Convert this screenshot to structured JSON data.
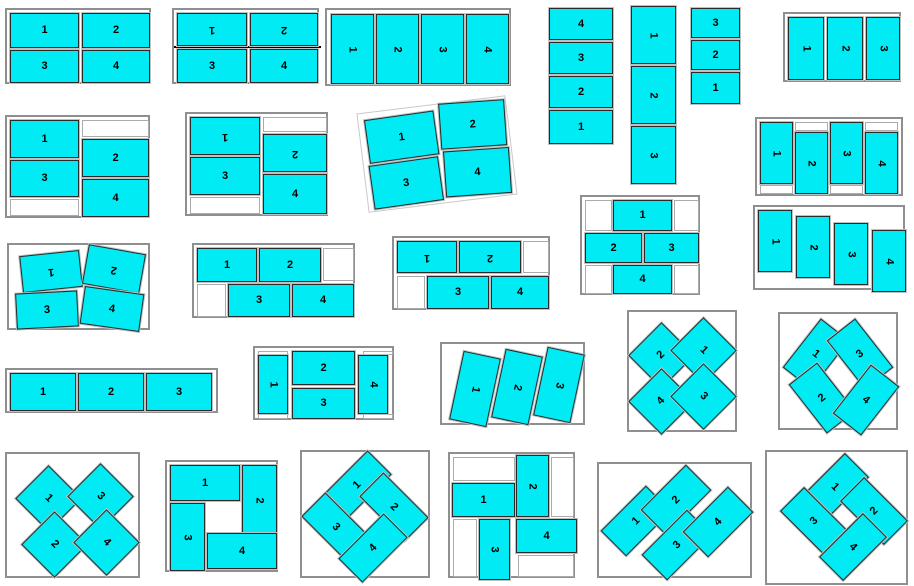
{
  "canvas": {
    "width": 914,
    "height": 586,
    "background": "#ffffff"
  },
  "palette": {
    "cell_fill": "#00ebf3",
    "cell_border": "#2a2a2a",
    "group_border": "#8f8f8f",
    "empty_cell_fill": "#ffffff",
    "separator_color": "#000000",
    "label_color": "#000000"
  },
  "groups": [
    {
      "name": "layout-2x2-grid",
      "cells": [
        "1",
        "2",
        "3",
        "4"
      ]
    },
    {
      "name": "layout-2x2-head-to-head",
      "cells": [
        "1",
        "2",
        "3",
        "4"
      ]
    },
    {
      "name": "layout-4-across-rotated",
      "cells": [
        "1",
        "2",
        "3",
        "4"
      ]
    },
    {
      "name": "layout-stack-4-reversed",
      "cells": [
        "4",
        "3",
        "2",
        "1"
      ]
    },
    {
      "name": "layout-stack-3-rotated",
      "cells": [
        "1",
        "2",
        "3"
      ]
    },
    {
      "name": "layout-stack-3-reversed",
      "cells": [
        "3",
        "2",
        "1"
      ]
    },
    {
      "name": "layout-3-across-rotated",
      "cells": [
        "1",
        "2",
        "3"
      ]
    },
    {
      "name": "layout-2col-staggered",
      "cells": [
        "1",
        "3",
        "2",
        "4"
      ]
    },
    {
      "name": "layout-2col-staggered-head-to-head",
      "cells": [
        "1",
        "3",
        "2",
        "4"
      ]
    },
    {
      "name": "layout-2x2-tilted",
      "cells": [
        "1",
        "2",
        "3",
        "4"
      ]
    },
    {
      "name": "layout-4col-alternating",
      "cells": [
        "1",
        "2",
        "3",
        "4"
      ]
    },
    {
      "name": "layout-brick-pyramid",
      "cells": [
        "1",
        "2",
        "3",
        "4"
      ]
    },
    {
      "name": "layout-2x2-jostled-head-to-head",
      "cells": [
        "1",
        "2",
        "3",
        "4"
      ]
    },
    {
      "name": "layout-brick-offset",
      "cells": [
        "1",
        "2",
        "3",
        "4"
      ]
    },
    {
      "name": "layout-brick-offset-head-to-head",
      "cells": [
        "1",
        "2",
        "3",
        "4"
      ]
    },
    {
      "name": "layout-4col-staircase",
      "cells": [
        "1",
        "2",
        "3",
        "4"
      ]
    },
    {
      "name": "layout-3-across",
      "cells": [
        "1",
        "2",
        "3"
      ]
    },
    {
      "name": "layout-h-frame",
      "cells": [
        "1",
        "2",
        "3",
        "4"
      ]
    },
    {
      "name": "layout-3col-tilted",
      "cells": [
        "1",
        "2",
        "3"
      ]
    },
    {
      "name": "layout-diamond-quad",
      "cells": [
        "2",
        "1",
        "4",
        "3"
      ]
    },
    {
      "name": "layout-x-weave",
      "cells": [
        "1",
        "3",
        "2",
        "4"
      ]
    },
    {
      "name": "layout-diamond-quad-b",
      "cells": [
        "1",
        "3",
        "2",
        "4"
      ]
    },
    {
      "name": "layout-pinwheel",
      "cells": [
        "1",
        "2",
        "3",
        "4"
      ]
    },
    {
      "name": "layout-diamond-ring",
      "cells": [
        "1",
        "2",
        "3",
        "4"
      ]
    },
    {
      "name": "layout-pinwheel-staggered",
      "cells": [
        "2",
        "1",
        "3",
        "4"
      ]
    },
    {
      "name": "layout-zigzag-diagonal",
      "cells": [
        "1",
        "2",
        "3",
        "4"
      ]
    },
    {
      "name": "layout-x-pinwheel",
      "cells": [
        "1",
        "2",
        "3",
        "4"
      ]
    }
  ]
}
